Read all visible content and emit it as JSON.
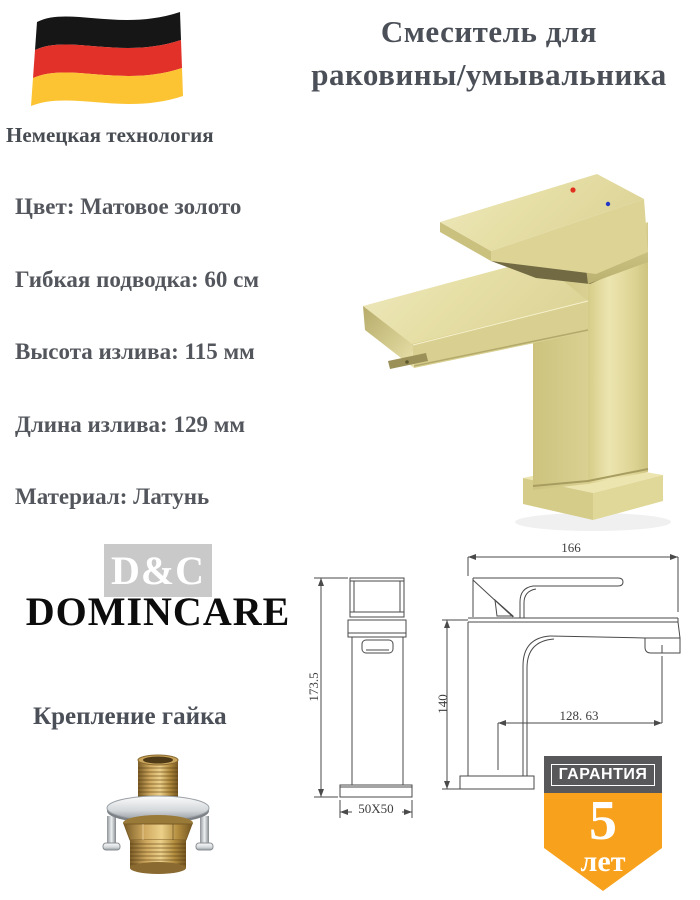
{
  "header": {
    "title_line1": "Смеситель для",
    "title_line2": "раковины/умывальника",
    "subtitle": "Немецкая технология"
  },
  "specs": [
    "Цвет: Матовое золото",
    "Гибкая подводка: 60 см",
    "Высота излива: 115 мм",
    "Длина излива: 129 мм",
    "Материал: Латунь"
  ],
  "brand": {
    "abbr": "D&C",
    "name": "DOMINCARE"
  },
  "mount": {
    "label": "Крепление гайка"
  },
  "warranty": {
    "header": "ГАРАНТИЯ",
    "years": "5",
    "unit": "лет"
  },
  "drawings": {
    "front": {
      "height": "173.5",
      "base": "50X50"
    },
    "side": {
      "width": "166",
      "height": "140",
      "spout": "128. 63"
    }
  },
  "colors": {
    "text_slate": "#4B4F57",
    "accent_orange": "#F8A11C",
    "badge_gray": "#58585B",
    "flag_black": "#161616",
    "flag_red": "#E23128",
    "flag_gold": "#FCC433",
    "faucet_gold": "#DED695",
    "hot_dot": "#E23020",
    "cold_dot": "#2438C8"
  }
}
